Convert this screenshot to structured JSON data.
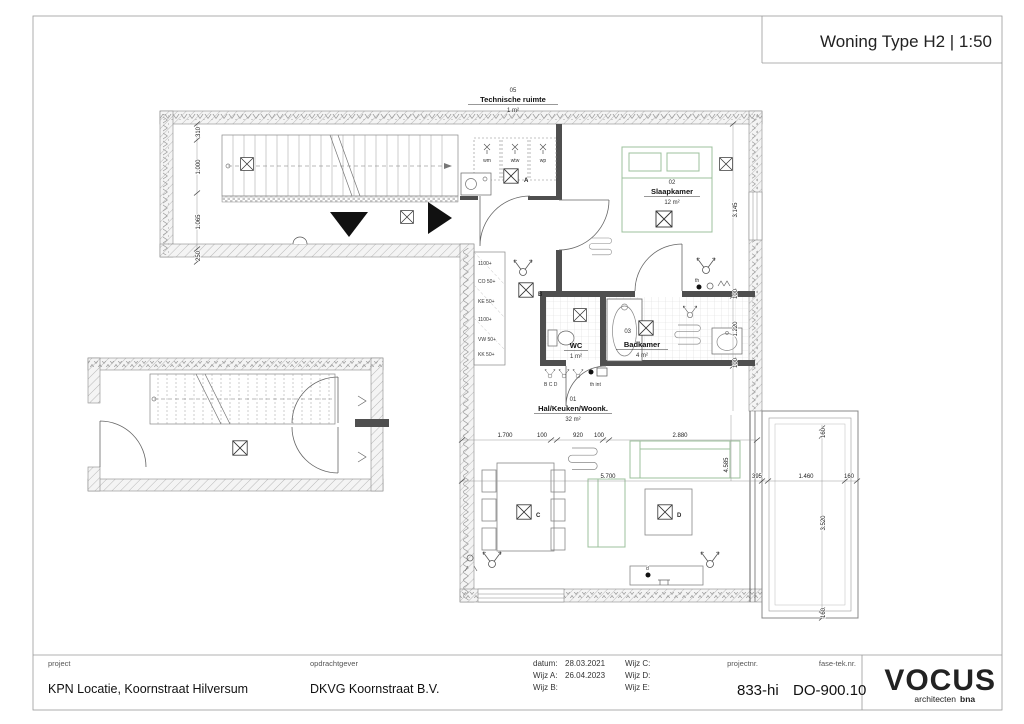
{
  "sheet": {
    "title": "Woning Type H2 | 1:50"
  },
  "rooms": {
    "technische": {
      "number": "05",
      "name": "Technische ruimte",
      "area": "1 m²"
    },
    "slaapkamer": {
      "number": "02",
      "name": "Slaapkamer",
      "area": "12 m²"
    },
    "wc": {
      "name": "WC",
      "area": "1 m²"
    },
    "badkamer": {
      "number": "03",
      "name": "Badkamer",
      "area": "4 m²"
    },
    "hal": {
      "number": "01",
      "name": "Hal/Keuken/Woonk.",
      "area": "32 m²"
    }
  },
  "labels": {
    "wm": "wm",
    "wtw": "wtw",
    "wp": "wp",
    "outlets": [
      "1100+",
      "CO 50+",
      "KE 50+",
      "1100+",
      "VW 50+",
      "KK 50+"
    ],
    "marker_a": "A",
    "marker_b": "B",
    "marker_c": "C",
    "marker_d": "D",
    "marker_bcd": "B  C  D",
    "marker_th": "th",
    "marker_th_int": "th int",
    "marker_d_dot": "d"
  },
  "dimensions": {
    "bottom": [
      "1.700",
      "100",
      "920",
      "100",
      "2.880"
    ],
    "total_width": "5.700",
    "living_height": "4.585",
    "balcony_offset": "395",
    "balcony_width": "1.460",
    "balcony_wall": "160",
    "balcony_top": "160",
    "balcony_height": "3.520",
    "balcony_bottom": "160",
    "right": [
      "3.145",
      "100",
      "1.220",
      "100"
    ],
    "left": [
      "310",
      "1.000",
      "1.065",
      "250"
    ]
  },
  "titleblock": {
    "project_label": "project",
    "project_value": "KPN Locatie, Koornstraat Hilversum",
    "client_label": "opdrachtgever",
    "client_value": "DKVG Koornstraat B.V.",
    "datum_label": "datum:",
    "datum_value": "28.03.2021",
    "wijz_a_label": "Wijz A:",
    "wijz_a_value": "26.04.2023",
    "wijz_b_label": "Wijz B:",
    "wijz_c_label": "Wijz C:",
    "wijz_d_label": "Wijz D:",
    "wijz_e_label": "Wijz E:",
    "projectnr_label": "projectnr.",
    "projectnr_value": "833-hi",
    "fase_label": "fase-tek.nr.",
    "fase_value": "DO-900.10",
    "logo_text": "VOCUS",
    "logo_sub": "architecten",
    "logo_sub2": "bna"
  },
  "colors": {
    "logo_teal": "#2f9db0",
    "logo_yellow": "#c4b63c",
    "logo_dark": "#243240",
    "furniture_green": "#9cc09c",
    "wall_dark": "#4f4f4f"
  }
}
